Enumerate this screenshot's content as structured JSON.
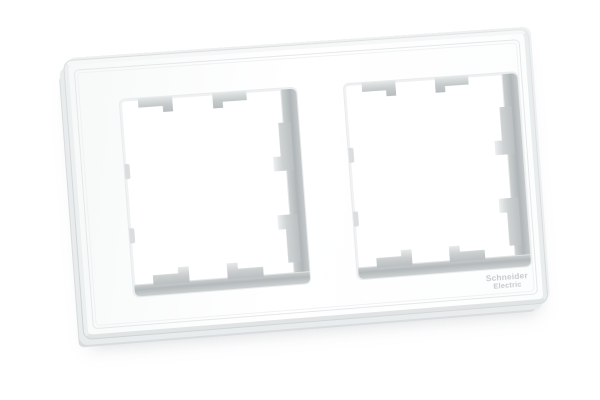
{
  "scene": {
    "type": "product-photo",
    "background_color": "#ffffff",
    "subject": "White two-gang wall switch/socket surround frame, photographed at a slight angle on a plain white background"
  },
  "frame": {
    "color": "#ffffff",
    "openings": 2,
    "inner_wall_color": "#b4b9bb",
    "clip_color": "#c7cbcd",
    "clips_per_opening": {
      "top": 2,
      "bottom": 2,
      "right": 2,
      "left_nubs": 2
    }
  },
  "logo": {
    "line1": "Schneider",
    "line2": "Electric",
    "color": "#c6cacc"
  }
}
